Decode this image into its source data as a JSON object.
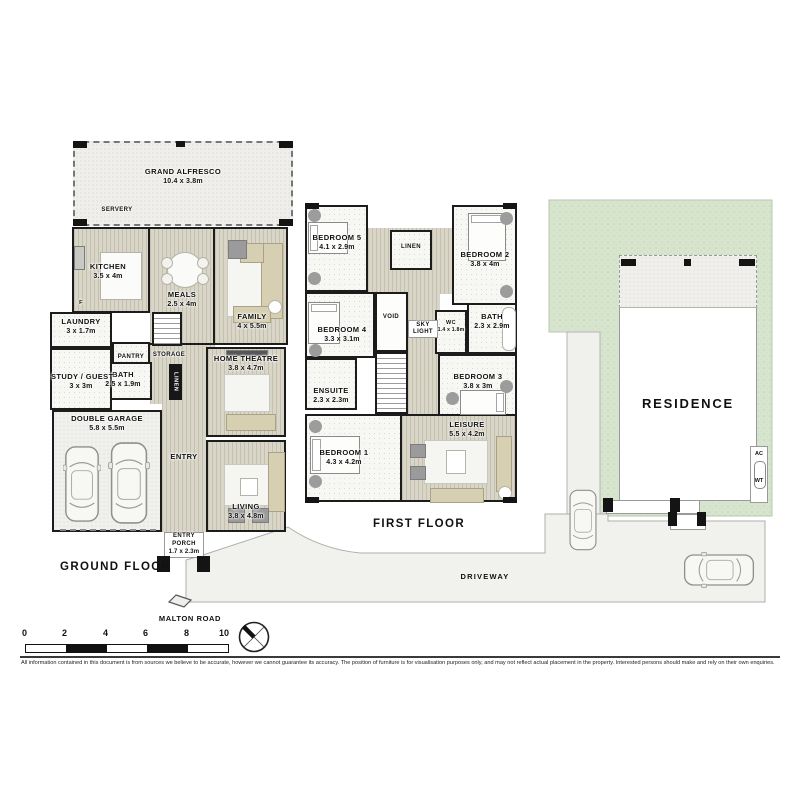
{
  "ground_floor": {
    "label": "GROUND FLOOR",
    "rooms": {
      "alfresco": {
        "name": "GRAND ALFRESCO",
        "dims": "10.4 x 3.8m"
      },
      "servery": {
        "name": "SERVERY"
      },
      "kitchen": {
        "name": "KITCHEN",
        "dims": "3.5 x 4m"
      },
      "fridge": {
        "name": "F"
      },
      "meals": {
        "name": "MEALS",
        "dims": "2.5 x 4m"
      },
      "family": {
        "name": "FAMILY",
        "dims": "4 x 5.5m"
      },
      "laundry": {
        "name": "LAUNDRY",
        "dims": "3 x 1.7m"
      },
      "pantry": {
        "name": "PANTRY"
      },
      "storage": {
        "name": "STORAGE"
      },
      "bath": {
        "name": "BATH",
        "dims": "2.5 x 1.9m"
      },
      "linen": {
        "name": "LINEN"
      },
      "study": {
        "name": "STUDY / GUEST",
        "dims": "3 x 3m"
      },
      "garage": {
        "name": "DOUBLE GARAGE",
        "dims": "5.8 x 5.5m"
      },
      "entry": {
        "name": "ENTRY"
      },
      "home_theatre": {
        "name": "HOME THEATRE",
        "dims": "3.8 x 4.7m"
      },
      "living": {
        "name": "LIVING",
        "dims": "3.8 x 4.8m"
      },
      "porch_entry": {
        "name": "ENTRY"
      },
      "porch": {
        "name": "PORCH",
        "dims": "1.7 x 2.3m"
      }
    }
  },
  "first_floor": {
    "label": "FIRST FLOOR",
    "rooms": {
      "bedroom5": {
        "name": "BEDROOM 5",
        "dims": "4.1 x 2.9m"
      },
      "linen": {
        "name": "LINEN"
      },
      "bedroom2": {
        "name": "BEDROOM 2",
        "dims": "3.8 x 4m"
      },
      "void": {
        "name": "VOID"
      },
      "skylight": {
        "name": "SKY LIGHT"
      },
      "wc": {
        "name": "WC",
        "dims": "1.4 x 1.8m"
      },
      "bath": {
        "name": "BATH",
        "dims": "2.3 x 2.9m"
      },
      "bedroom4": {
        "name": "BEDROOM 4",
        "dims": "3.3 x 3.1m"
      },
      "ensuite": {
        "name": "ENSUITE",
        "dims": "2.3 x 2.3m"
      },
      "bedroom3": {
        "name": "BEDROOM 3",
        "dims": "3.8 x 3m"
      },
      "bedroom1": {
        "name": "BEDROOM 1",
        "dims": "4.3 x 4.2m"
      },
      "leisure": {
        "name": "LEISURE",
        "dims": "5.5 x 4.2m"
      }
    }
  },
  "site": {
    "residence_label": "RESIDENCE",
    "ac_label": "AC",
    "wt_label": "WT",
    "driveway_label": "DRIVEWAY",
    "road_label": "MALTON ROAD"
  },
  "scale_bar": {
    "ticks": [
      "0",
      "2",
      "4",
      "6",
      "8",
      "10"
    ]
  },
  "footer": {
    "disclaimer": "All information contained in this document is from sources we believe to be accurate, however we cannot guarantee its accuracy. The position of furniture is for visualisation purposes only, and may not reflect actual placement in the property. Interested persons should make and rely on their own enquiries."
  },
  "colors": {
    "wall": "#1c1c1c",
    "wood_floor": "#d9d5c7",
    "grass": "#d8e5ce",
    "driveway": "#f1f1ee",
    "room_white": "#f7f7f4"
  }
}
